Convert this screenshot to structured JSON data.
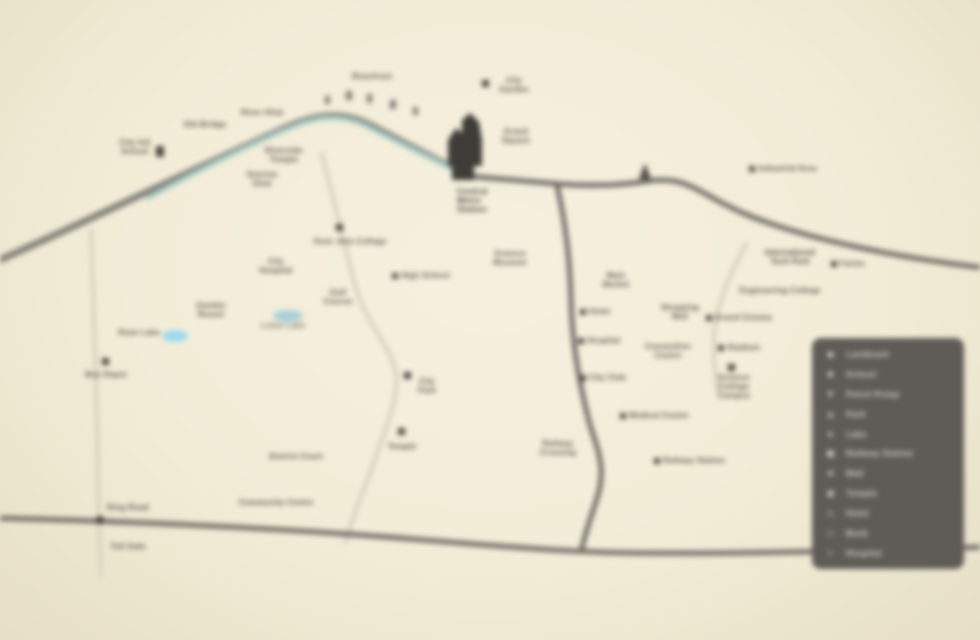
{
  "map": {
    "background_color": "#f2ecd7",
    "river_color": "#a9cfc9",
    "river_bank_color": "#83817a",
    "road_dark_color": "#6f6b65",
    "road_light_color": "#d7d0bc",
    "pond_color": "#9ed9ef",
    "label_ink_color": "#57514b",
    "site_building_color": "#3f3c38"
  },
  "markers": [
    {
      "text": "City Intl\nSchool"
    },
    {
      "text": "Old Bridge"
    },
    {
      "text": "River Ghat"
    },
    {
      "text": "Riverside\nTemple"
    },
    {
      "text": "Sunrise\nGhat"
    },
    {
      "text": "Riverfront"
    },
    {
      "text": "City\nGarden"
    },
    {
      "text": "Grand\nSquare"
    },
    {
      "text": "Central\nMetro\nStation"
    },
    {
      "text": "Govt. Arts College"
    },
    {
      "text": "City\nHospital"
    },
    {
      "text": "High School"
    },
    {
      "text": "Science\nMuseum"
    },
    {
      "text": "Golf\nCourse"
    },
    {
      "text": "Lotus Lake"
    },
    {
      "text": "Rose Lake"
    },
    {
      "text": "Garden\nResort"
    },
    {
      "text": "Bus Depot"
    },
    {
      "text": "City\nPark"
    },
    {
      "text": "Temple"
    },
    {
      "text": "District Court"
    },
    {
      "text": "Community Centre"
    },
    {
      "text": "Ring Road"
    },
    {
      "text": "Toll Gate"
    },
    {
      "text": "Industrial Area"
    },
    {
      "text": "Main\nMarket"
    },
    {
      "text": "International\nTech Park"
    },
    {
      "text": "Farms"
    },
    {
      "text": "Engineering College"
    },
    {
      "text": "Hotel"
    },
    {
      "text": "Shopping\nMall"
    },
    {
      "text": "Grand Cinema"
    },
    {
      "text": "Hospital"
    },
    {
      "text": "Convention\nCentre"
    },
    {
      "text": "Stadium"
    },
    {
      "text": "City Club"
    },
    {
      "text": "Science\nCollege\nCampus"
    },
    {
      "text": "Medical Centre"
    },
    {
      "text": "Railway\nCrossing"
    },
    {
      "text": "Railway Station"
    }
  ],
  "legend": {
    "items": [
      {
        "icon": "◆",
        "label": "Landmark"
      },
      {
        "icon": "■",
        "label": "School"
      },
      {
        "icon": "▼",
        "label": "Petrol Pump"
      },
      {
        "icon": "▲",
        "label": "Park"
      },
      {
        "icon": "●",
        "label": "Lake"
      },
      {
        "icon": "▣",
        "label": "Railway Station"
      },
      {
        "icon": "★",
        "label": "Mall"
      },
      {
        "icon": "◉",
        "label": "Temple"
      },
      {
        "icon": "◇",
        "label": "Hotel"
      },
      {
        "icon": "□",
        "label": "Bank"
      },
      {
        "icon": "+",
        "label": "Hospital"
      }
    ]
  }
}
